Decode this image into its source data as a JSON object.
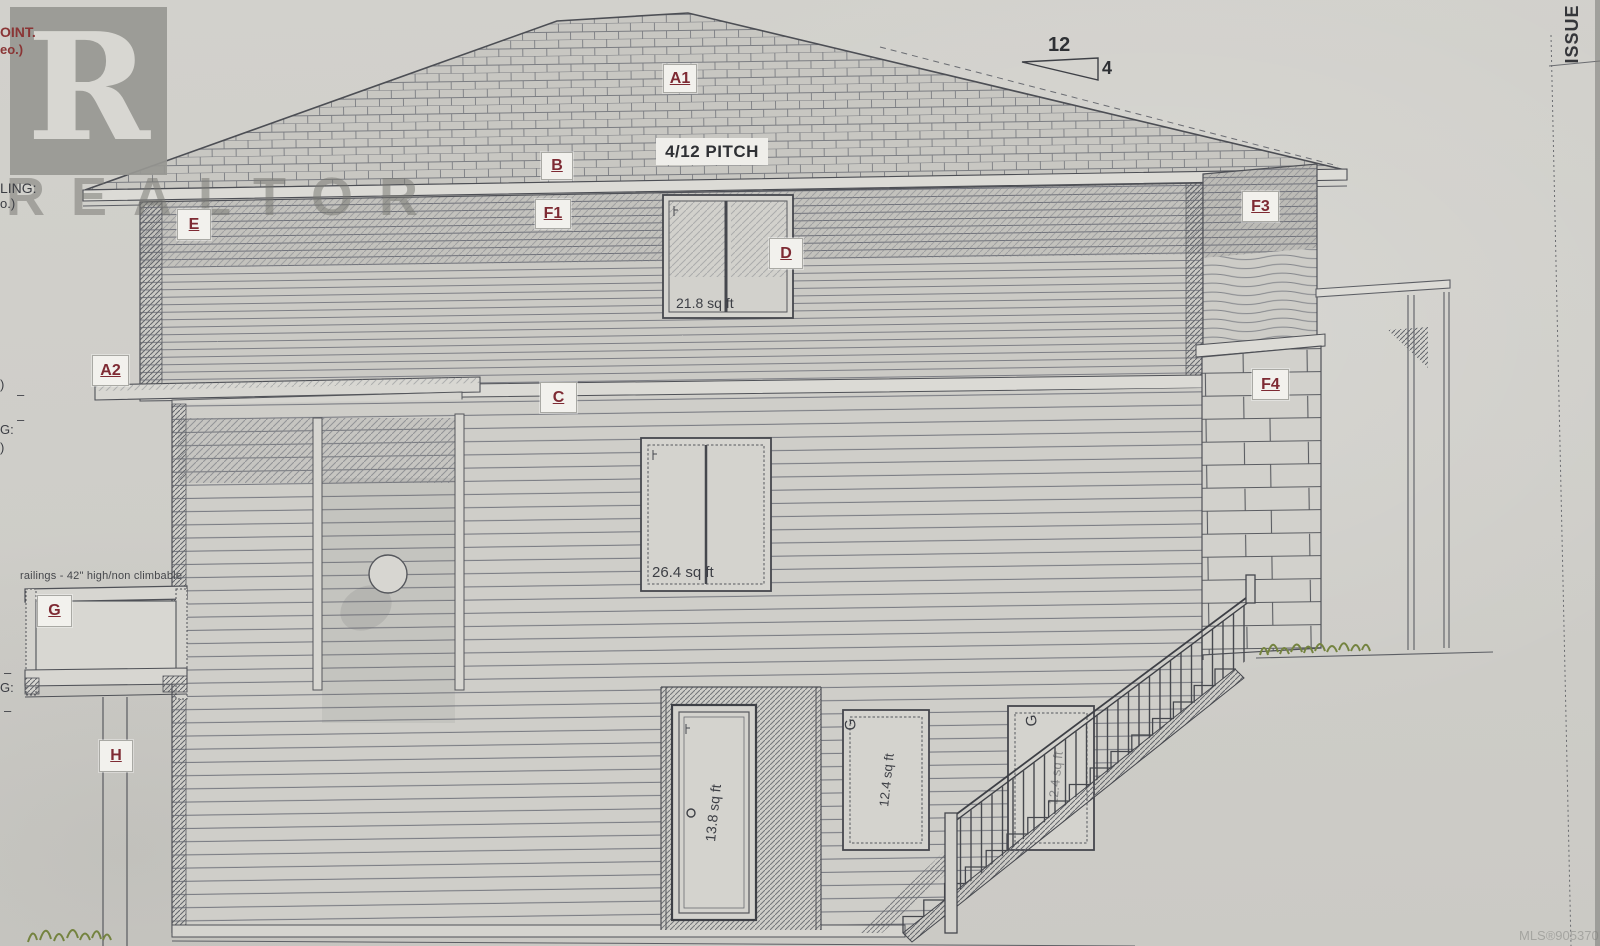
{
  "sheet": {
    "side_label": "ISSUE",
    "mls_number": "MLS®905370"
  },
  "watermark": {
    "logo_letter": "R",
    "brand": "REALTOR"
  },
  "edge_fragments": {
    "top1": "OINT.",
    "top2": "eo.)",
    "mid1": "LING:",
    "mid2": "o.)",
    "paren": ")",
    "dash": "–",
    "g_note": "G:"
  },
  "roof": {
    "label": "A1",
    "pitch_text": "4/12 PITCH",
    "pitch_rise": "12",
    "pitch_run": "4"
  },
  "ref_labels": {
    "a2": "A2",
    "b": "B",
    "c": "C",
    "d": "D",
    "e": "E",
    "f1": "F1",
    "f3": "F3",
    "f4": "F4",
    "g": "G",
    "h": "H"
  },
  "openings": {
    "upper_window_area": "21.8 sq ft",
    "main_window_area": "26.4 sq ft",
    "basement_door_area": "13.8 sq ft",
    "basement_window1": {
      "tag": "G",
      "area": "12.4 sq ft"
    },
    "basement_window2": {
      "tag": "G",
      "area": "12.4 sq ft"
    }
  },
  "notes": {
    "railing": "railings - 42\" high/non climbable"
  },
  "colors": {
    "paper": "#d2d1cc",
    "ink": "#55575c",
    "label_red": "#7e2a33",
    "watermark_gray": "#979793",
    "vegetation_green": "#74833f"
  }
}
